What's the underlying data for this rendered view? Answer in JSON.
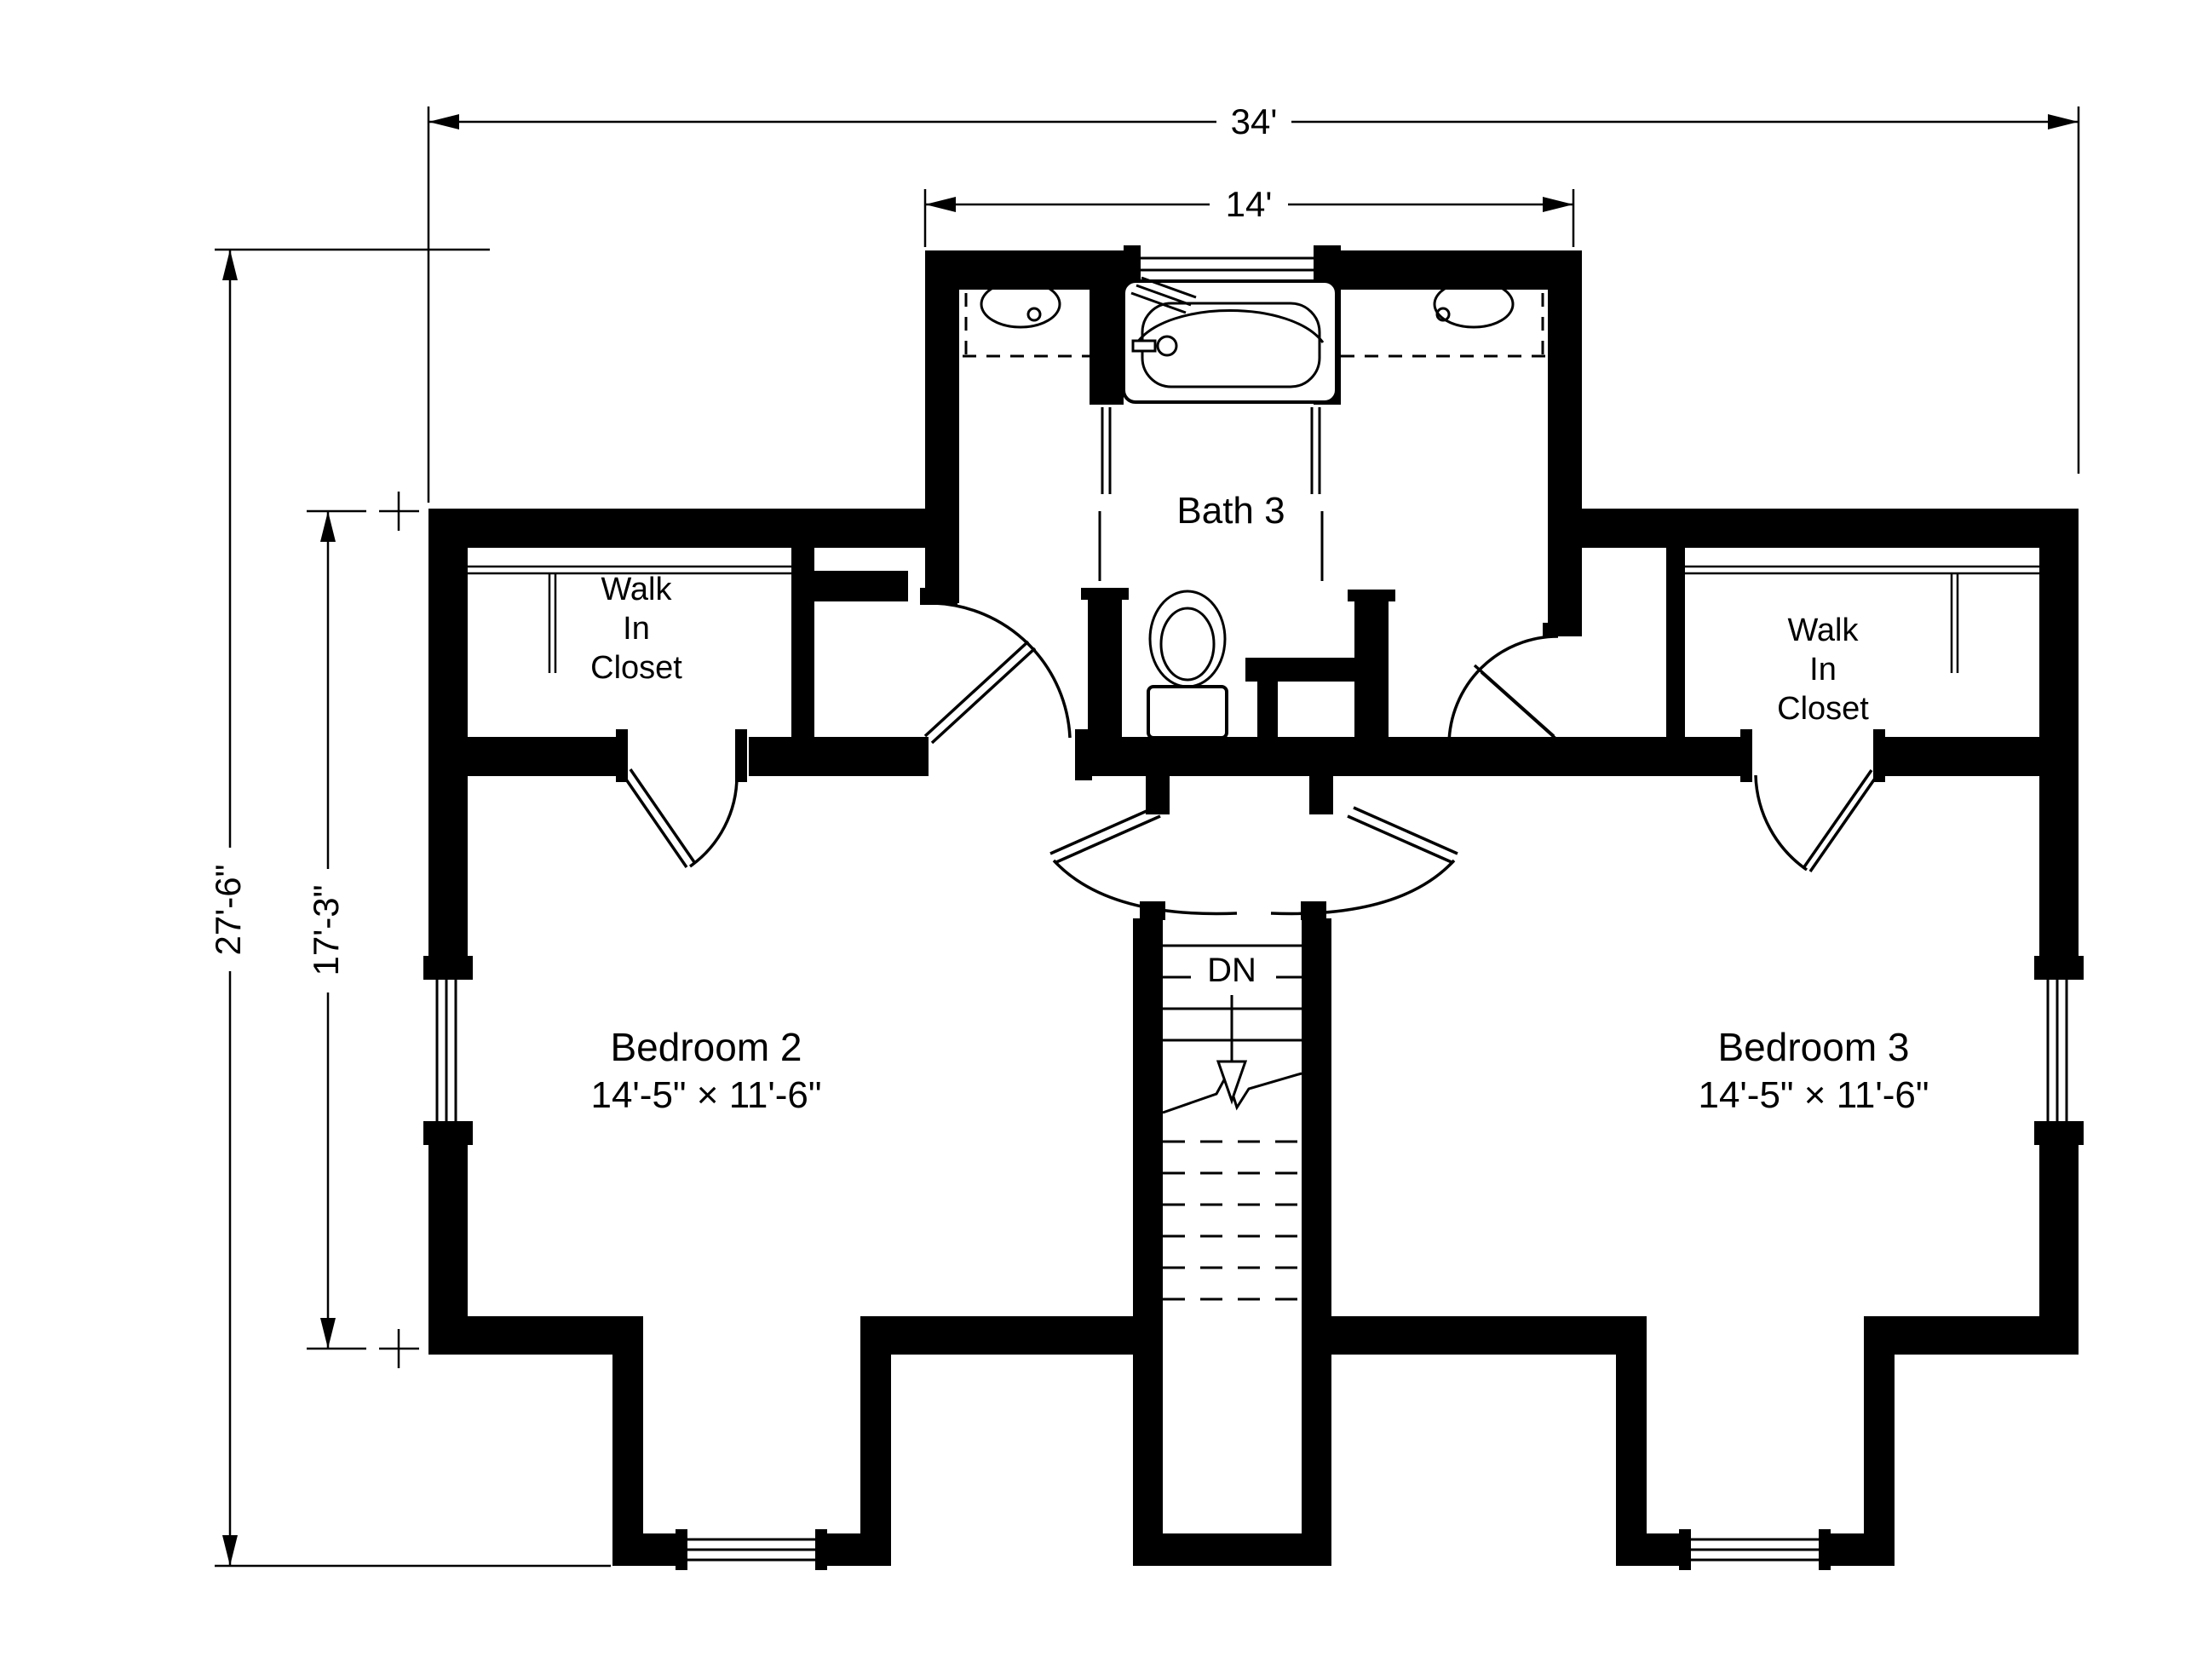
{
  "dimensions": {
    "overall_width": "34'",
    "bath_wing_width": "14'",
    "overall_depth": "27'-6\"",
    "bedroom_wing_depth": "17'-3\""
  },
  "rooms": {
    "bath": {
      "label": "Bath 3"
    },
    "left_closet": {
      "line1": "Walk",
      "line2": "In",
      "line3": "Closet"
    },
    "right_closet": {
      "line1": "Walk",
      "line2": "In",
      "line3": "Closet"
    },
    "bedroom2": {
      "label": "Bedroom 2",
      "size": "14'-5\" × 11'-6\""
    },
    "bedroom3": {
      "label": "Bedroom 3",
      "size": "14'-5\" × 11'-6\""
    }
  },
  "stairs": {
    "label": "DN"
  },
  "colors": {
    "line": "#000000",
    "background": "#ffffff"
  }
}
